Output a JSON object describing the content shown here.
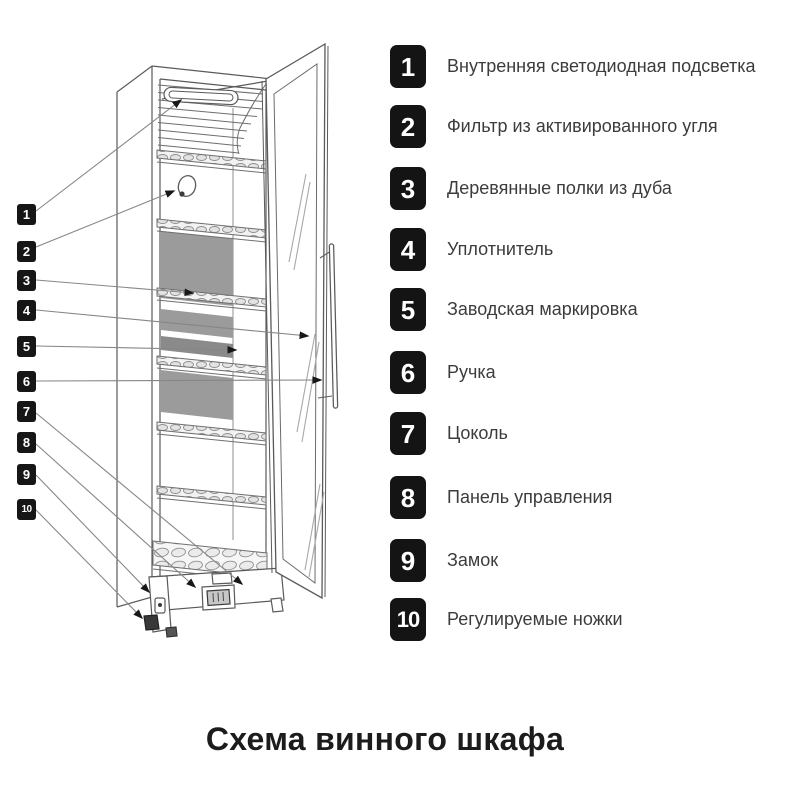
{
  "title": "Схема винного шкафа",
  "legend": {
    "items": [
      {
        "num": "1",
        "label": "Внутренняя светодиодная подсветка"
      },
      {
        "num": "2",
        "label": "Фильтр из активированного угля"
      },
      {
        "num": "3",
        "label": "Деревянные полки из дуба"
      },
      {
        "num": "4",
        "label": "Уплотнитель"
      },
      {
        "num": "5",
        "label": "Заводская маркировка"
      },
      {
        "num": "6",
        "label": "Ручка"
      },
      {
        "num": "7",
        "label": "Цоколь"
      },
      {
        "num": "8",
        "label": "Панель управления"
      },
      {
        "num": "9",
        "label": "Замок"
      },
      {
        "num": "10",
        "label": "Регулируемые ножки"
      }
    ]
  },
  "callouts": {
    "nums": [
      "1",
      "2",
      "3",
      "4",
      "5",
      "6",
      "7",
      "8",
      "9",
      "10"
    ]
  },
  "colors": {
    "chip_bg": "#141414",
    "chip_text": "#ffffff",
    "line_work": "#5a5a5a",
    "callout_line": "#868686",
    "back_panel_gray": "#9b9b9b",
    "marking_strip_gray": "#8a8a8a",
    "label_text": "#3c3c3c",
    "background": "#ffffff"
  }
}
